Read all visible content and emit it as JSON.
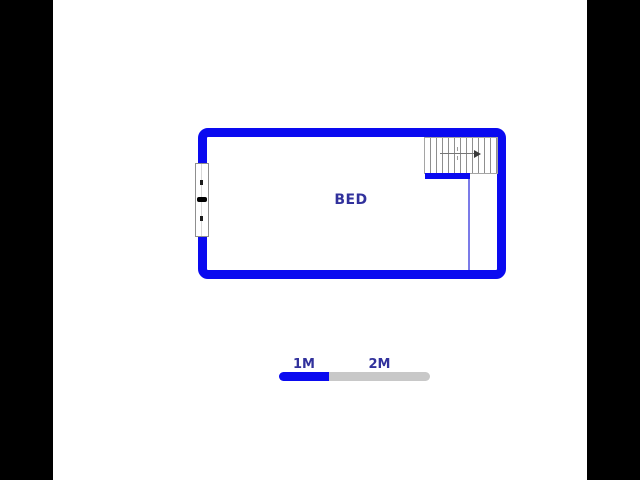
{
  "colors": {
    "background": "#ffffff",
    "letterbox": "#000000",
    "wall": "#0a0af0",
    "label": "#31319c",
    "scale_gray": "#c8c8c8",
    "stair_line": "#8f8f8f",
    "opening_line": "#7b7be8",
    "window_border": "#8f8f8f"
  },
  "floorplan": {
    "room_label": "BED"
  },
  "scale_bar": {
    "segment_1_label": "1M",
    "segment_2_label": "2M"
  }
}
